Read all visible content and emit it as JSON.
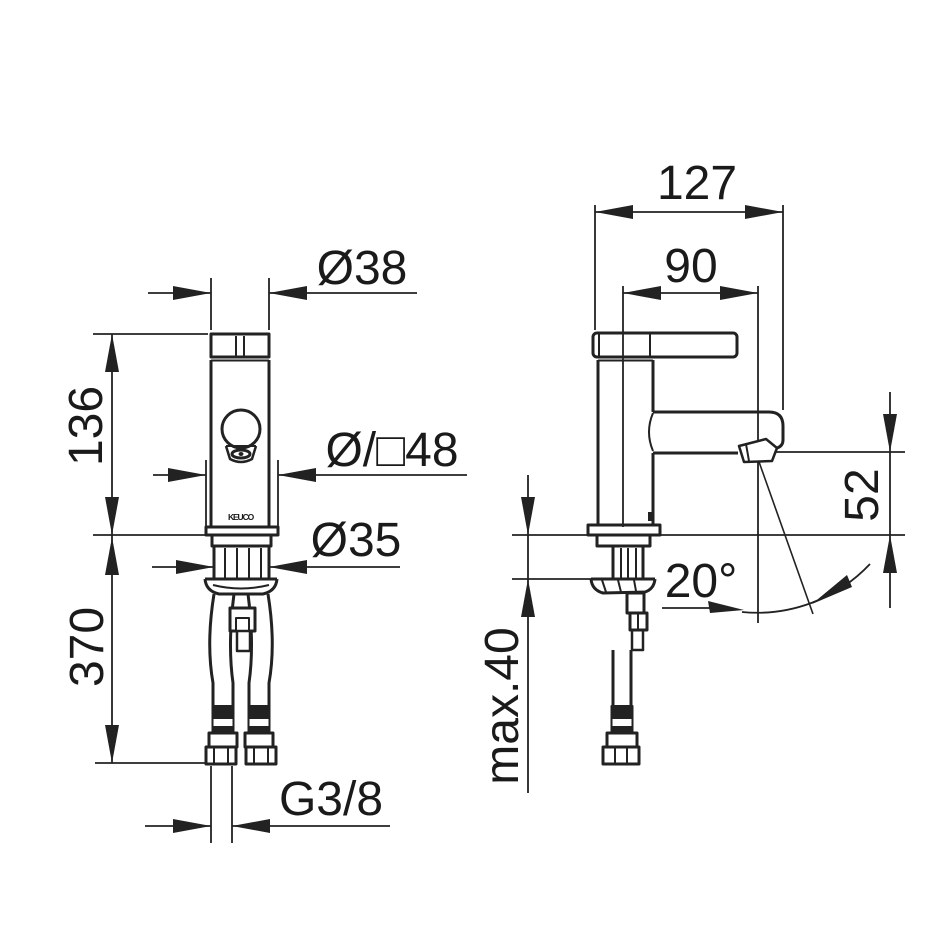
{
  "drawing": {
    "type": "technical-dimension-drawing",
    "product_logo": "KEUCO",
    "front_view": {
      "dim_handle_diameter": "Ø38",
      "dim_body_height": "136",
      "dim_escutcheon": "Ø/□48",
      "dim_shank_diameter": "Ø35",
      "dim_hose_length": "370",
      "dim_thread": "G3/8"
    },
    "side_view": {
      "dim_total_depth": "127",
      "dim_spout_projection": "90",
      "dim_outlet_height": "52",
      "dim_jet_angle": "20°",
      "dim_max_mounting": "max.40"
    },
    "colors": {
      "line": "#222222",
      "text": "#1a1a1a",
      "background": "#ffffff"
    }
  }
}
